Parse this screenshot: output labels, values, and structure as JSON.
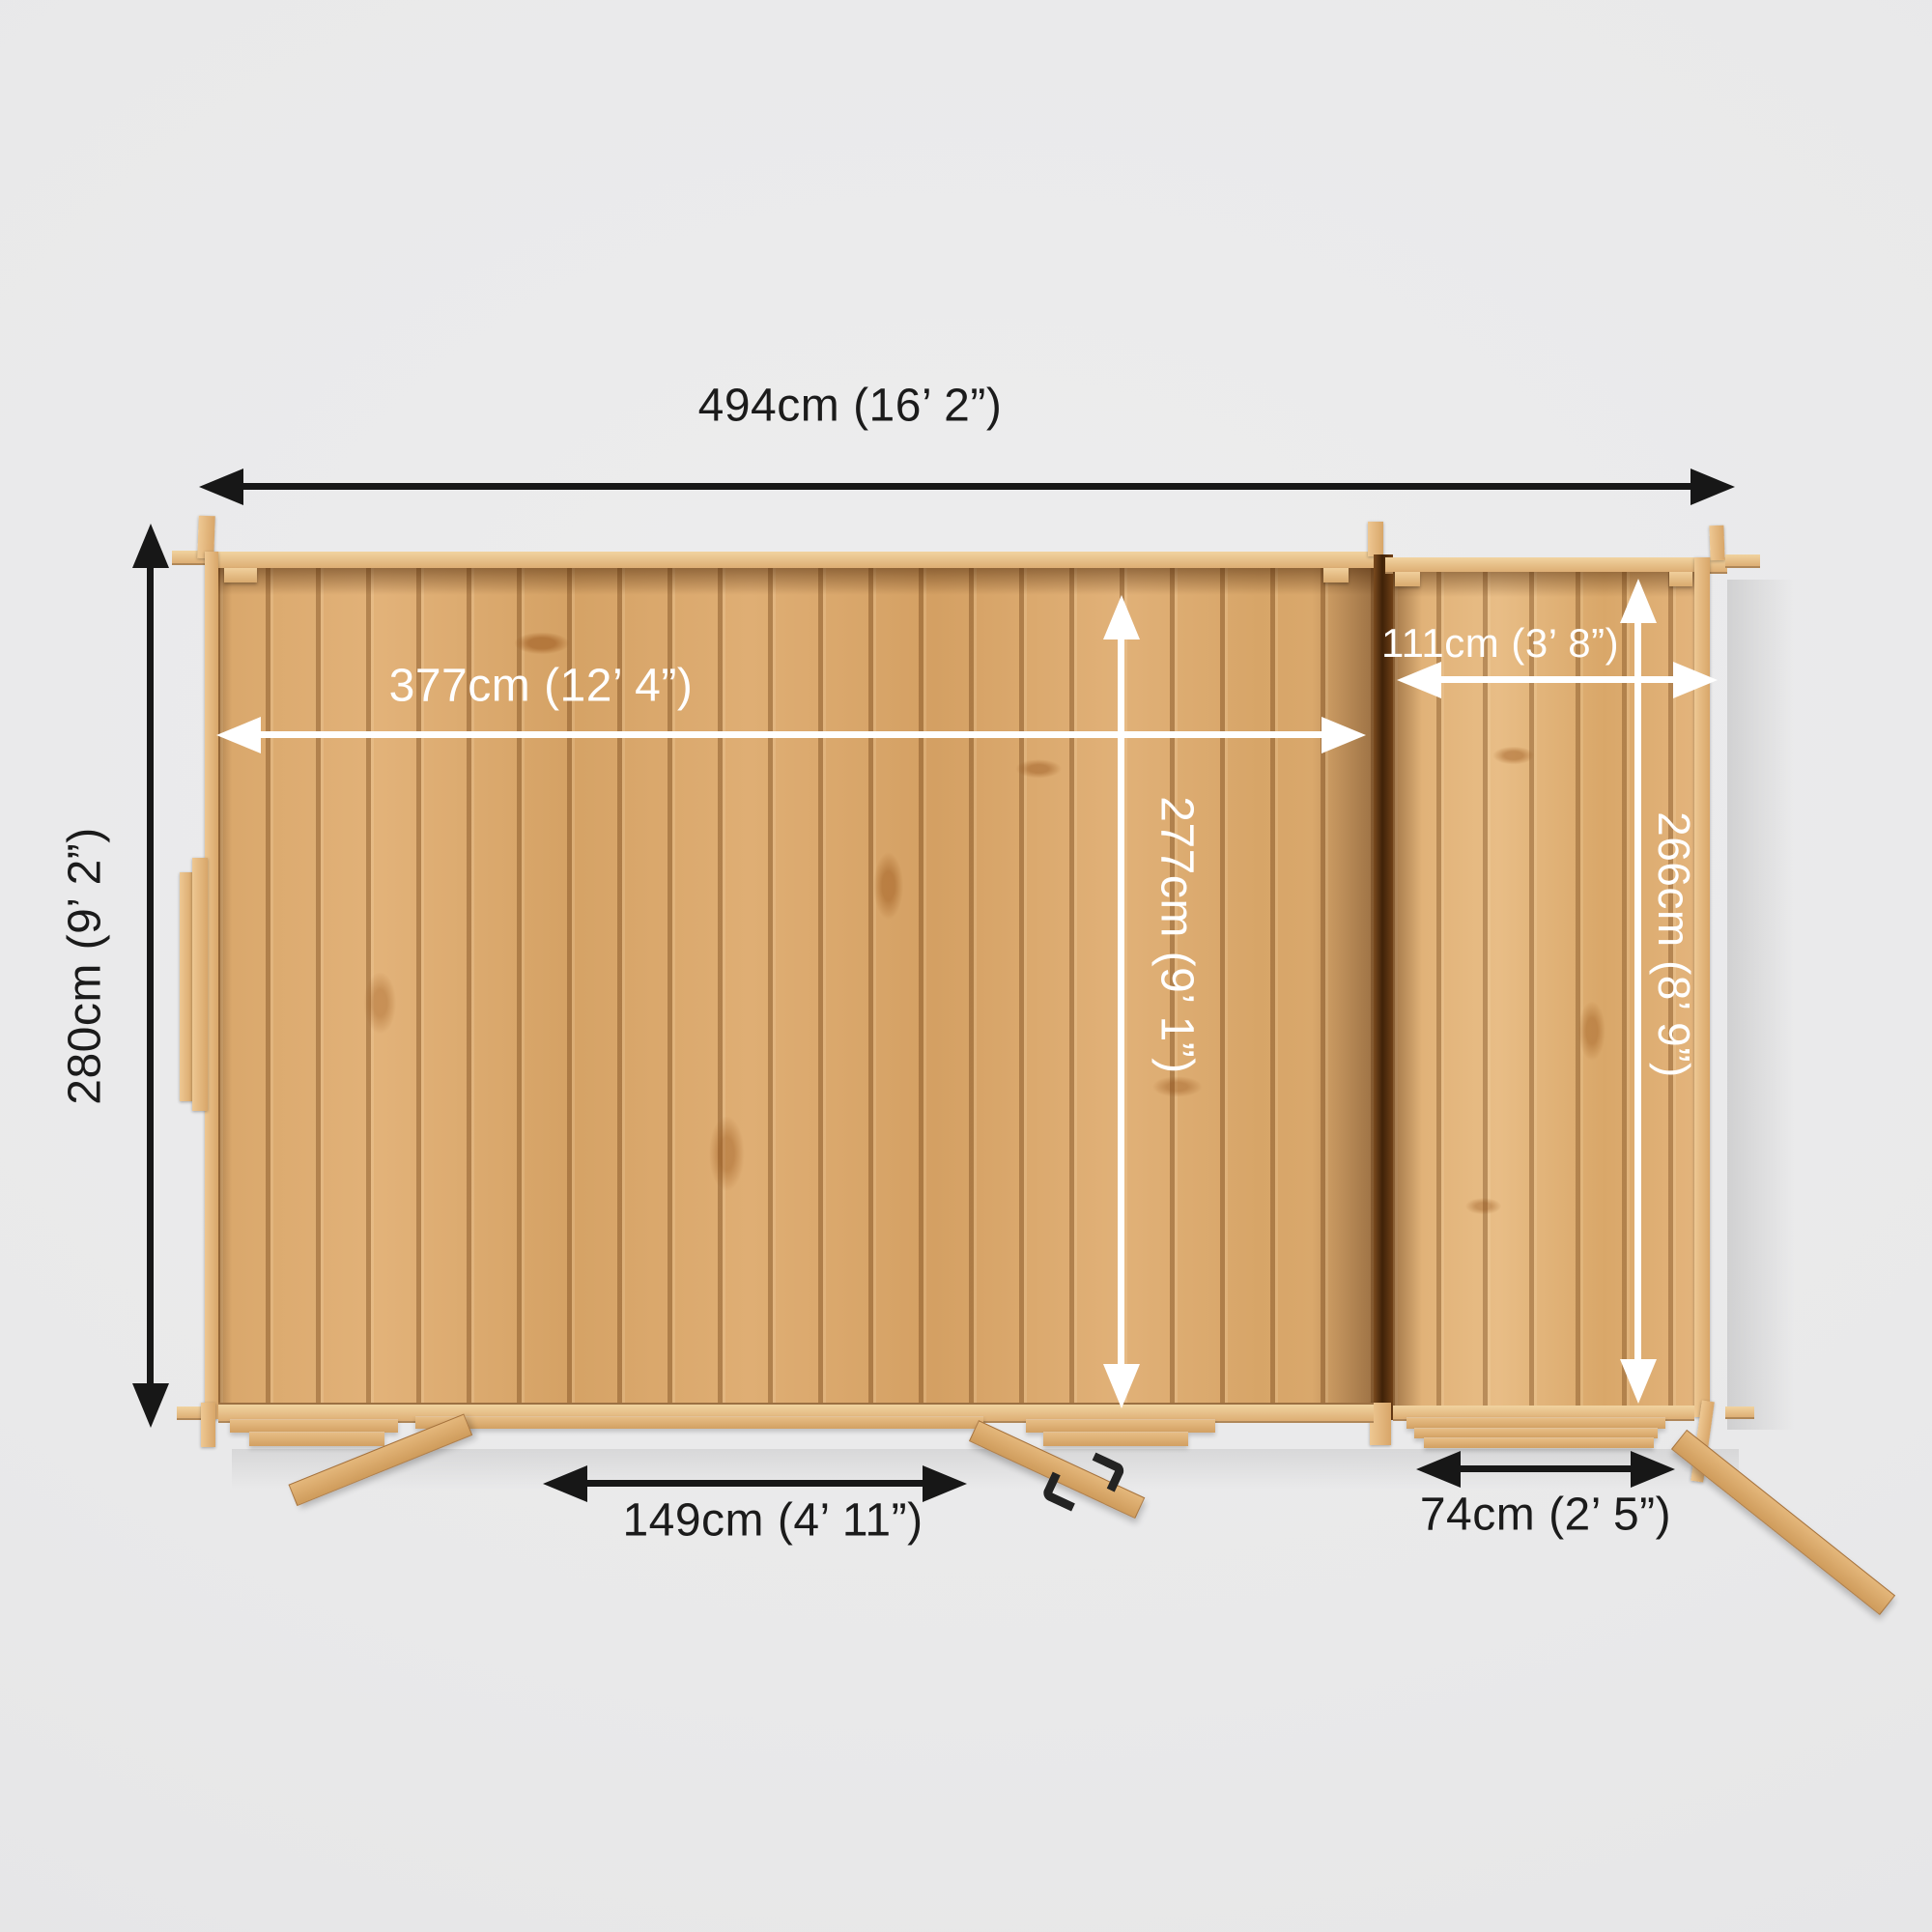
{
  "scene": {
    "type": "product-dimension-diagram",
    "subject": "log cabin with side annex, top-down view",
    "background_color": "#e9e9ea",
    "wood_color": "#dcab72",
    "annotation_colors": {
      "outer_arrows": "#171717",
      "inner_arrows": "#ffffff"
    }
  },
  "dimensions": {
    "overall_width": "494cm (16’ 2”)",
    "overall_depth": "280cm (9’ 2”)",
    "main_interior_width": "377cm (12’ 4”)",
    "main_interior_depth": "277cm (9’ 1”)",
    "annex_interior_width": "111cm (3’ 8”)",
    "annex_interior_depth": "266cm (8’ 9”)",
    "main_door_width": "149cm (4’ 11”)",
    "annex_door_width": "74cm (2’ 5”)"
  }
}
